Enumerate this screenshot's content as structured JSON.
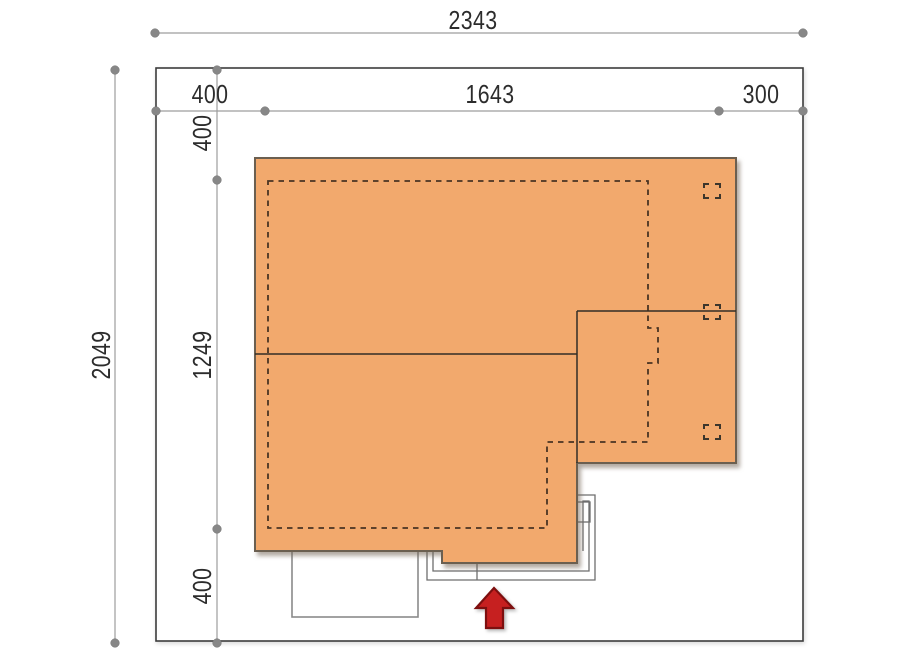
{
  "plan": {
    "type": "house-site-plan",
    "dims": {
      "total_width": "2343",
      "setback_left": "400",
      "building_width": "1643",
      "setback_right": "300",
      "total_height": "2049",
      "setback_top": "400",
      "building_depth": "1249",
      "setback_bottom": "400"
    },
    "colors": {
      "roof_fill": "#F2A96D",
      "arrow_red": "#C62020",
      "plot_border": "#3C3C3C",
      "dim_gray": "#9D9D9D",
      "dash_brown": "#4A3423"
    },
    "icons": {
      "entrance_arrow": "up-arrow",
      "chimney_marker": "dashed-square"
    }
  }
}
